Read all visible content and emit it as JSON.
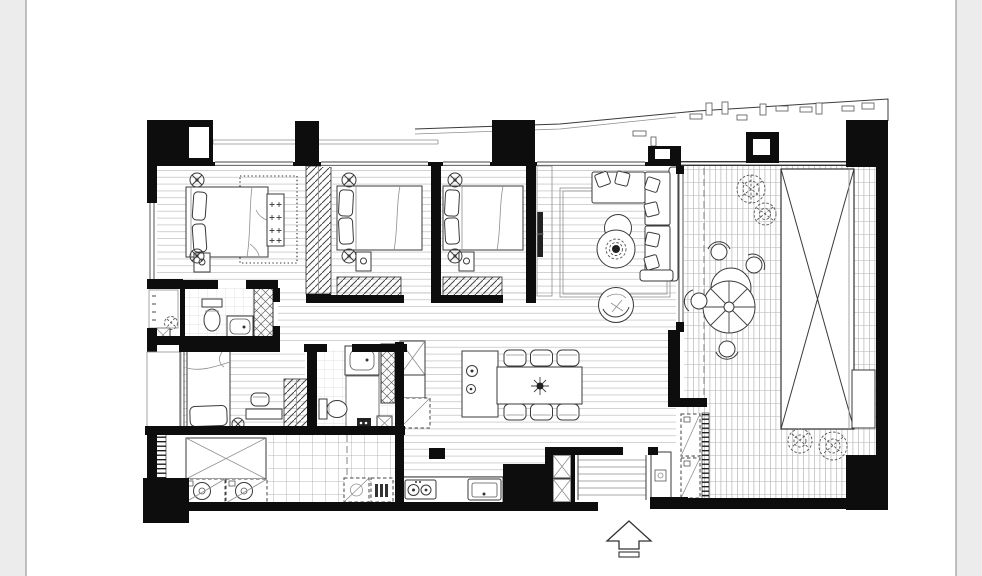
{
  "scene": {
    "kind": "black-and-white architectural floor plan of an apartment with roof terrace",
    "orientation_marker": "hollow arrow pointing up at main entrance, bottom center",
    "text_labels_present": false
  },
  "palette": {
    "background": "#ececec",
    "page": "#ffffff",
    "page_border": "#9a9a9a",
    "ink": "#0d0d0d",
    "line": "#3a3a3a",
    "floor_line": "#c7c7c7",
    "tile_line": "#a4a4a4"
  },
  "rooms": [
    {
      "id": "master-bedroom",
      "label": "master bedroom",
      "items": [
        "double bed with two pillows",
        "buttoned bench at bed foot",
        "dotted rug",
        "nightstand",
        "two ceiling-light symbols"
      ]
    },
    {
      "id": "bedroom-2",
      "label": "bedroom 2",
      "items": [
        "double bed",
        "nightstand",
        "hatched wardrobe",
        "two ceiling-light symbols"
      ]
    },
    {
      "id": "bedroom-3",
      "label": "bedroom 3",
      "items": [
        "double bed",
        "nightstand",
        "hatched wardrobe",
        "two ceiling-light symbols"
      ]
    },
    {
      "id": "bedroom-4",
      "label": "small bedroom",
      "items": [
        "single bed",
        "desk",
        "chair",
        "hatched wardrobe",
        "ceiling-light symbol"
      ]
    },
    {
      "id": "living-room",
      "label": "living room",
      "items": [
        "sectional sofa with chaise and pillows",
        "two overlapping round coffee tables",
        "round armchair",
        "area rug",
        "wall-mounted TV"
      ]
    },
    {
      "id": "dining-area",
      "label": "dining area",
      "items": [
        "rectangular table for six",
        "six chairs",
        "island counter with basin",
        "pendant centerpiece",
        "pantry shaft",
        "dashed refrigerator"
      ]
    },
    {
      "id": "kitchen",
      "label": "kitchen",
      "items": [
        "two-burner cooktop",
        "sink",
        "two dashed under-counter appliances",
        "tall black cabinet block",
        "tiled floor"
      ]
    },
    {
      "id": "laundry",
      "label": "laundry / storage",
      "items": [
        "X-crossed storage counter",
        "washer",
        "dryer",
        "vent rung strip"
      ]
    },
    {
      "id": "master-bathroom",
      "label": "master bathroom",
      "items": [
        "toilet",
        "vanity basin",
        "cross-hatched shower stall",
        "plant",
        "shaft box"
      ]
    },
    {
      "id": "bathroom-2",
      "label": "bathroom 2",
      "items": [
        "vanity basin",
        "toilet",
        "cross-hatched shower strip",
        "shaft box"
      ]
    },
    {
      "id": "entry",
      "label": "entry hall",
      "items": [
        "entry steps",
        "two X-crossed service shafts",
        "shoe cabinet"
      ]
    },
    {
      "id": "terrace",
      "label": "roof terrace",
      "items": [
        "wood decking grid",
        "round outdoor table with parasol segments",
        "four curved chairs",
        "large X-crossed planter",
        "four scribbled plants",
        "two dashed AC units",
        "bench"
      ]
    },
    {
      "id": "wardrobe-corridor",
      "label": "walk-through wardrobe",
      "items": [
        "diagonal hatch clothes rail"
      ]
    }
  ],
  "entrance": {
    "arrow_direction": "up"
  }
}
